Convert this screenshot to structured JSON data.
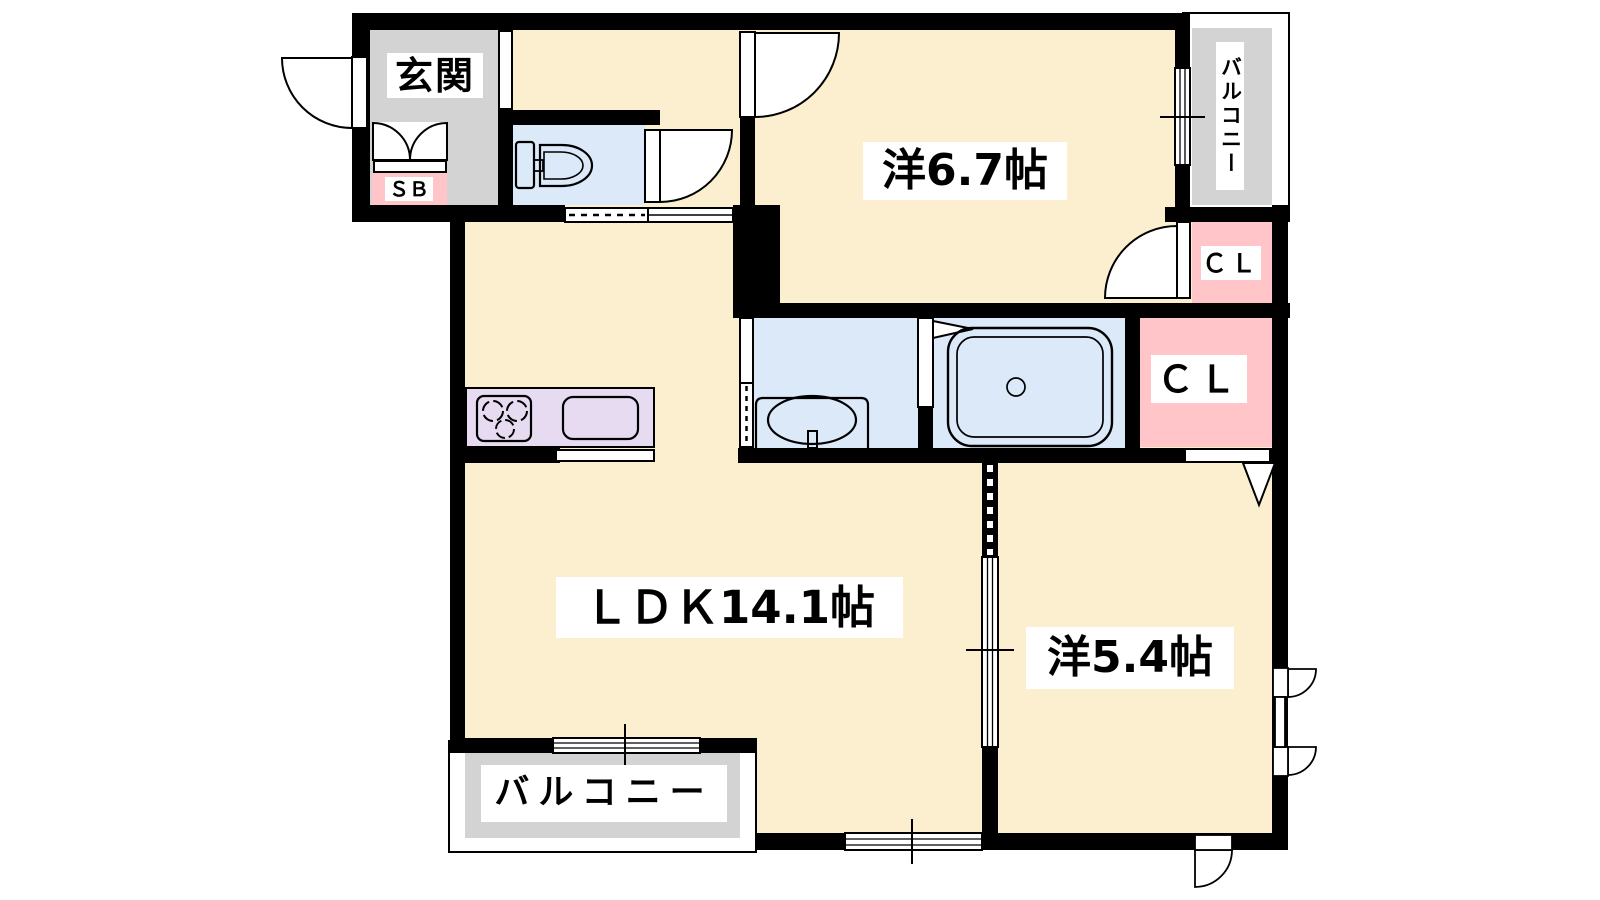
{
  "plan": {
    "type": "japanese-apartment-floorplan",
    "labels": {
      "genkan": "玄関",
      "shoe_box": "ＳＢ",
      "western_room_1": "洋6.7帖",
      "balcony_top": "バルコニー",
      "closet_top": "ＣＬ",
      "closet_main": "ＣＬ",
      "ldk": "ＬＤＫ14.1帖",
      "western_room_2": "洋5.4帖",
      "balcony_bottom": "バルコニー"
    },
    "rooms": [
      {
        "name": "entrance",
        "label": "玄関",
        "floor_color": "#D3D3D3"
      },
      {
        "name": "shoe-box",
        "label": "ＳＢ",
        "floor_color": "#FFC5C9"
      },
      {
        "name": "toilet",
        "label": "",
        "floor_color": "#DBE9F8"
      },
      {
        "name": "western-room-6.7",
        "label": "洋6.7帖",
        "floor_color": "#FBEFCF"
      },
      {
        "name": "balcony-top",
        "label": "バルコニー",
        "floor_color": "#D3D3D3"
      },
      {
        "name": "closet-top",
        "label": "ＣＬ",
        "floor_color": "#FFC5C9"
      },
      {
        "name": "washroom",
        "label": "",
        "floor_color": "#DBE9F8"
      },
      {
        "name": "bathroom",
        "label": "",
        "floor_color": "#DBE9F8"
      },
      {
        "name": "closet-main",
        "label": "ＣＬ",
        "floor_color": "#FFC5C9"
      },
      {
        "name": "ldk",
        "label": "ＬＤＫ14.1帖",
        "floor_color": "#FBEFCF"
      },
      {
        "name": "kitchen-counter",
        "label": "",
        "floor_color": "#E7DBF1"
      },
      {
        "name": "western-room-5.4",
        "label": "洋5.4帖",
        "floor_color": "#FBEFCF"
      },
      {
        "name": "balcony-bottom",
        "label": "バルコニー",
        "floor_color": "#D3D3D3"
      }
    ],
    "fixtures": [
      "toilet",
      "washbasin",
      "bathtub",
      "gas-stove-3-burner",
      "kitchen-sink"
    ],
    "colors": {
      "wall": "#000000",
      "room_cream": "#FBEFCF",
      "outdoor_gray": "#D3D3D3",
      "wet_area_blue": "#DBE9F8",
      "closet_pink": "#FFC5C9",
      "kitchen_lavender": "#E7DBF1",
      "label_bg": "#FFFFFF"
    }
  }
}
